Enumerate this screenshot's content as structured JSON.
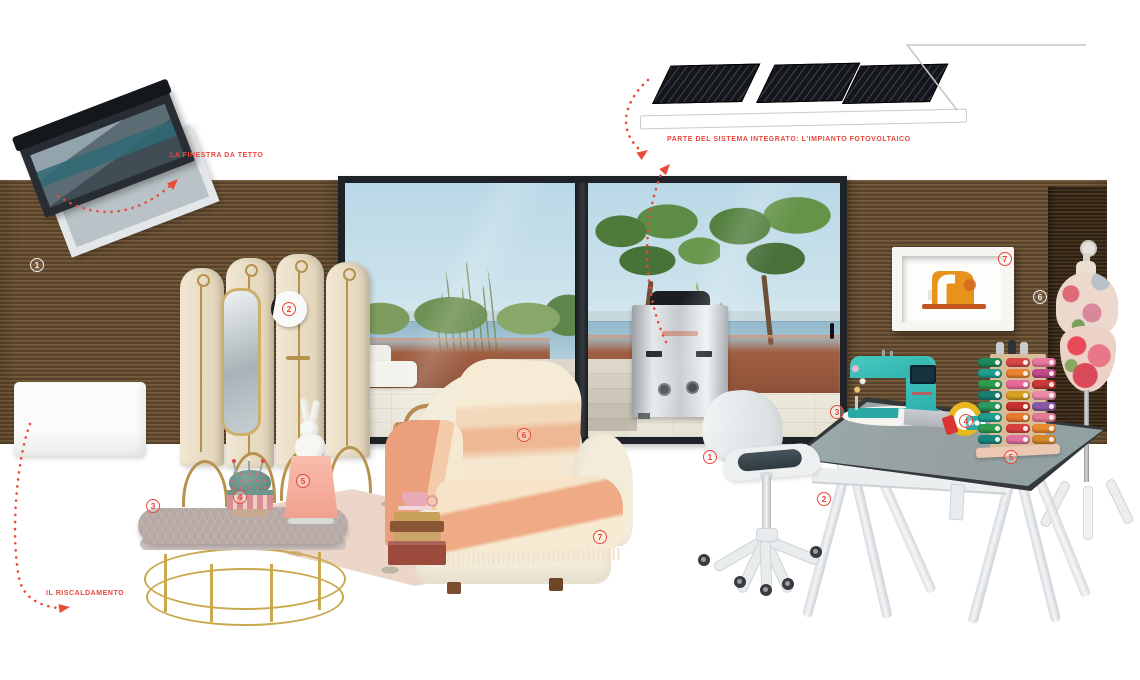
{
  "page": {
    "background": "#ffffff",
    "accent": "#e8473b"
  },
  "labels": {
    "skylight": "LA FINESTRA DA TETTO",
    "photovoltaic": "PARTE DEL SISTEMA INTEGRATO: L'IMPIANTO FOTOVOLTAICO",
    "heating": "IL RISCALDAMENTO"
  },
  "markers": [
    {
      "n": "1",
      "x": 37,
      "y": 265,
      "variant": "light",
      "name": "marker-wall-1"
    },
    {
      "n": "2",
      "x": 289,
      "y": 309,
      "variant": "accent",
      "name": "marker-screen-2"
    },
    {
      "n": "3",
      "x": 153,
      "y": 506,
      "variant": "accent",
      "name": "marker-table-3"
    },
    {
      "n": "4",
      "x": 240,
      "y": 497,
      "variant": "accent",
      "name": "marker-pincushion-4"
    },
    {
      "n": "5",
      "x": 303,
      "y": 481,
      "variant": "accent",
      "name": "marker-lamp-5"
    },
    {
      "n": "6",
      "x": 524,
      "y": 435,
      "variant": "accent",
      "name": "marker-armchair-6"
    },
    {
      "n": "7",
      "x": 600,
      "y": 537,
      "variant": "accent",
      "name": "marker-rug-7"
    },
    {
      "n": "1",
      "x": 710,
      "y": 457,
      "variant": "accent",
      "name": "marker-chair-1"
    },
    {
      "n": "2",
      "x": 824,
      "y": 499,
      "variant": "accent",
      "name": "marker-desk-2"
    },
    {
      "n": "3",
      "x": 837,
      "y": 412,
      "variant": "accent",
      "name": "marker-sewing-machine-3"
    },
    {
      "n": "4",
      "x": 966,
      "y": 421,
      "variant": "accent",
      "name": "marker-accessories-4"
    },
    {
      "n": "5",
      "x": 1011,
      "y": 457,
      "variant": "accent",
      "name": "marker-thread-rack-5"
    },
    {
      "n": "6",
      "x": 1040,
      "y": 297,
      "variant": "light",
      "name": "marker-wall-panel-6"
    },
    {
      "n": "7",
      "x": 1005,
      "y": 259,
      "variant": "accent",
      "name": "marker-frame-art-7"
    }
  ],
  "thread_rack": {
    "cap_colors": [
      "#c8ccd0",
      "#2e3236",
      "#c8ccd0"
    ],
    "rows": [
      [
        "#1e8a5a",
        "#d84848",
        "#e878a0"
      ],
      [
        "#1f9e90",
        "#e8822e",
        "#c04a8a"
      ],
      [
        "#2e9c50",
        "#e86a9a",
        "#c83838"
      ],
      [
        "#177f72",
        "#d8a020",
        "#e88aa8"
      ],
      [
        "#2a9a60",
        "#c83030",
        "#8858a8"
      ],
      [
        "#1f9e90",
        "#e8792e",
        "#e87898"
      ],
      [
        "#2e9c50",
        "#d84040",
        "#e88a30"
      ],
      [
        "#18857a",
        "#e070a0",
        "#d88828"
      ]
    ]
  },
  "objects": [
    "roof-window",
    "solar-panels",
    "radiator",
    "room-divider-screen",
    "coffee-table",
    "pincushion",
    "rabbit-lamp",
    "rug",
    "armchair",
    "books-and-teacup",
    "heat-pump",
    "saddle-chair",
    "trestle-desk",
    "sewing-machine",
    "measuring-tape",
    "thread-spool-rack",
    "tailor-mannequin",
    "framed-sewing-machine-art",
    "sliding-glass-door",
    "terrace-view"
  ]
}
